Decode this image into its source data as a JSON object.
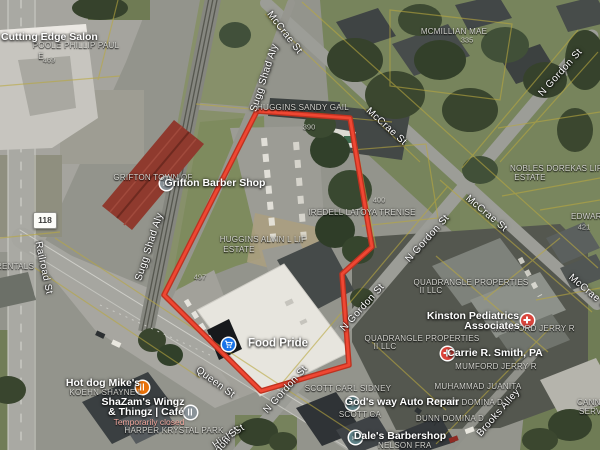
{
  "map": {
    "type": "satellite-view",
    "route_badge": "118",
    "colors": {
      "boundary_red": "#ef4733",
      "boundary_red_dark": "#bd3220",
      "poi_blue": "#1a73e8",
      "poi_orange": "#e8710a",
      "poi_medical_red": "#d9453c",
      "poi_teal": "#5f8389",
      "poi_gray": "#8a9399",
      "parcel_line_yellow": "#b9a83f"
    },
    "boundary": {
      "vertices": [
        [
          257,
          111
        ],
        [
          350,
          118
        ],
        [
          372,
          247
        ],
        [
          342,
          274
        ],
        [
          349,
          365
        ],
        [
          261,
          391
        ],
        [
          164,
          295
        ]
      ]
    },
    "markers": [
      {
        "name": "grifton-barber-shop-marker",
        "icon": "scissors-icon",
        "color": "#8a9399",
        "x": 166,
        "y": 183
      },
      {
        "name": "food-pride-marker",
        "icon": "cart-icon",
        "color": "#1a73e8",
        "x": 228,
        "y": 344
      },
      {
        "name": "hot-dog-mikes-marker",
        "icon": "dining-icon",
        "color": "#e8710a",
        "x": 142,
        "y": 387
      },
      {
        "name": "shazams-marker",
        "icon": "dining-icon",
        "color": "#8a9399",
        "x": 190,
        "y": 412
      },
      {
        "name": "kinston-pediatrics-marker",
        "icon": "medical-cross-icon",
        "color": "#d9453c",
        "x": 527,
        "y": 320
      },
      {
        "name": "carrie-smith-marker",
        "icon": "medical-cross-icon",
        "color": "#d9453c",
        "x": 447,
        "y": 353
      },
      {
        "name": "gods-way-marker",
        "icon": "wrench-icon",
        "color": "#5f8389",
        "x": 352,
        "y": 403
      },
      {
        "name": "dales-barbershop-marker",
        "icon": "scissors-icon",
        "color": "#5f8389",
        "x": 355,
        "y": 437
      }
    ],
    "labels": [
      {
        "type": "street",
        "text": "McCrae St",
        "x": 284,
        "y": 33,
        "rot": 52
      },
      {
        "type": "street",
        "text": "McCrae St",
        "x": 386,
        "y": 127,
        "rot": 42
      },
      {
        "type": "street",
        "text": "McCrae St",
        "x": 486,
        "y": 214,
        "rot": 40
      },
      {
        "type": "street",
        "text": "McCrae St",
        "x": 589,
        "y": 293,
        "rot": 40
      },
      {
        "type": "street",
        "text": "N Gordon St",
        "x": 561,
        "y": 73,
        "rot": -48
      },
      {
        "type": "street",
        "text": "N Gordon St",
        "x": 428,
        "y": 239,
        "rot": -48
      },
      {
        "type": "street",
        "text": "N Gordon St",
        "x": 363,
        "y": 308,
        "rot": -48
      },
      {
        "type": "street",
        "text": "N Gordon St",
        "x": 286,
        "y": 390,
        "rot": -48
      },
      {
        "type": "street",
        "text": "Queen St",
        "x": 215,
        "y": 383,
        "rot": 36
      },
      {
        "type": "street",
        "text": "Sugg Shad Aly",
        "x": 265,
        "y": 78,
        "rot": -72
      },
      {
        "type": "street",
        "text": "Sugg Shad Aly",
        "x": 150,
        "y": 247,
        "rot": -72
      },
      {
        "type": "street",
        "text": "Railroad St",
        "x": 43,
        "y": 268,
        "rot": 78
      },
      {
        "type": "street",
        "text": "Brooks Alley",
        "x": 499,
        "y": 413,
        "rot": -49
      },
      {
        "type": "street",
        "text": "High St",
        "x": 229,
        "y": 437,
        "rot": -33
      },
      {
        "type": "street",
        "text": "Gordon St",
        "x": 222,
        "y": 447,
        "rot": -49
      },
      {
        "type": "parcel",
        "text": "POOLE PHILLIP PAUL",
        "x": 76,
        "y": 46
      },
      {
        "type": "parcel",
        "text": "E",
        "x": 41,
        "y": 57
      },
      {
        "type": "parcel",
        "text": "GRIFTON TOWN OF",
        "x": 153,
        "y": 178
      },
      {
        "type": "parcel",
        "text": "MCMILLIAN MAE",
        "x": 454,
        "y": 32
      },
      {
        "type": "parcel",
        "text": "HUGGINS SANDY GAIL",
        "x": 303,
        "y": 108
      },
      {
        "type": "parcel",
        "text": "NOBLES DOREKAS LIF",
        "x": 556,
        "y": 169
      },
      {
        "type": "parcel",
        "text": "ESTATE",
        "x": 530,
        "y": 178
      },
      {
        "type": "parcel",
        "text": "IREDELL LATOYA TRENISE",
        "x": 362,
        "y": 213
      },
      {
        "type": "parcel",
        "text": "HUGGINS ALVIN L LIF",
        "x": 263,
        "y": 240
      },
      {
        "type": "parcel",
        "text": "ESTATE",
        "x": 239,
        "y": 250
      },
      {
        "type": "parcel",
        "text": "EDWARDS",
        "x": 571,
        "y": 217,
        "anchor": "left"
      },
      {
        "type": "parcel",
        "text": "QUADRANGLE PROPERTIES",
        "x": 471,
        "y": 283
      },
      {
        "type": "parcel",
        "text": "II LLC",
        "x": 431,
        "y": 291
      },
      {
        "type": "parcel",
        "text": "MUMFORD JERRY R",
        "x": 534,
        "y": 329
      },
      {
        "type": "parcel",
        "text": "QUADRANGLE PROPERTIES",
        "x": 422,
        "y": 339
      },
      {
        "type": "parcel",
        "text": "II LLC",
        "x": 385,
        "y": 347
      },
      {
        "type": "parcel",
        "text": "MUMFORD JERRY R",
        "x": 496,
        "y": 367
      },
      {
        "type": "parcel",
        "text": "MUHAMMAD JUANITA",
        "x": 478,
        "y": 387
      },
      {
        "type": "parcel",
        "text": "DUNN DOMINA D",
        "x": 469,
        "y": 403
      },
      {
        "type": "parcel",
        "text": "DUNN DOMINA D",
        "x": 450,
        "y": 419
      },
      {
        "type": "parcel",
        "text": "SCOTT CARL SIDNEY",
        "x": 348,
        "y": 389
      },
      {
        "type": "parcel",
        "text": "SCOTT CA",
        "x": 360,
        "y": 415
      },
      {
        "type": "parcel",
        "text": "HARPER KRYSTAL PARK",
        "x": 174,
        "y": 431
      },
      {
        "type": "parcel",
        "text": "KOEHN SHAYNE L",
        "x": 106,
        "y": 393
      },
      {
        "type": "parcel",
        "text": "NELSON FRA",
        "x": 378,
        "y": 446,
        "anchor": "left"
      },
      {
        "type": "parcel",
        "text": "CANNON",
        "x": 577,
        "y": 403,
        "anchor": "left"
      },
      {
        "type": "parcel",
        "text": "SERV",
        "x": 579,
        "y": 412,
        "anchor": "left"
      },
      {
        "type": "parcel",
        "text": "RENTALS",
        "x": -4,
        "y": 267,
        "anchor": "left"
      },
      {
        "type": "num",
        "text": "469",
        "x": 49,
        "y": 60
      },
      {
        "type": "num",
        "text": "335",
        "x": 467,
        "y": 40
      },
      {
        "type": "num",
        "text": "390",
        "x": 309,
        "y": 127
      },
      {
        "type": "num",
        "text": "400",
        "x": 379,
        "y": 200
      },
      {
        "type": "num",
        "text": "497",
        "x": 200,
        "y": 277
      },
      {
        "type": "num",
        "text": "421",
        "x": 584,
        "y": 227
      },
      {
        "type": "poi",
        "text": "Cutting Edge Salon",
        "x": 1,
        "y": 37,
        "anchor": "left"
      },
      {
        "type": "poi",
        "text": "Grifton Barber Shop",
        "x": 215,
        "y": 183
      },
      {
        "type": "poi-bold",
        "text": "Food Pride",
        "x": 278,
        "y": 344
      },
      {
        "type": "poi",
        "text": "Hot dog Mike's",
        "x": 103,
        "y": 383
      },
      {
        "type": "poi",
        "text": "ShaZam's Wingz",
        "x": 143,
        "y": 402
      },
      {
        "type": "poi",
        "text": "& Thingz | Café",
        "x": 146,
        "y": 412
      },
      {
        "type": "poi-closed",
        "text": "Temporarily closed",
        "x": 149,
        "y": 422
      },
      {
        "type": "poi",
        "text": "Kinston Pediatrics",
        "x": 473,
        "y": 316
      },
      {
        "type": "poi",
        "text": "Associates",
        "x": 492,
        "y": 326
      },
      {
        "type": "poi",
        "text": "Carrie R. Smith, PA",
        "x": 495,
        "y": 353
      },
      {
        "type": "poi",
        "text": "God's way Auto Repair",
        "x": 402,
        "y": 402
      },
      {
        "type": "poi",
        "text": "Dale's Barbershop",
        "x": 400,
        "y": 436
      }
    ]
  }
}
